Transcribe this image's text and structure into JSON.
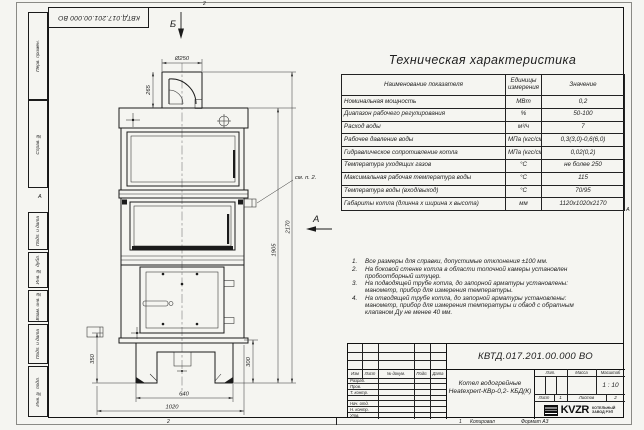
{
  "doc_number": "КВТД.017.201.00.000 ВО",
  "spec_table": {
    "title": "Техническая характеристика",
    "columns": [
      "Наименование показателя",
      "Единицы измерения",
      "Значение"
    ],
    "rows": [
      [
        "Номинальная мощность",
        "МВт",
        "0,2"
      ],
      [
        "Диапазон рабочего регулирования",
        "%",
        "50-100"
      ],
      [
        "Расход воды",
        "м³/ч",
        "7"
      ],
      [
        "Рабочее давление воды",
        "МПа (кгс/см²)",
        "0,3(3,0)-0,6(6,0)"
      ],
      [
        "Гидравлическое сопротивление котла",
        "МПа (кгс/см²)",
        "0,02(0,2)"
      ],
      [
        "Температура уходящих газов",
        "°С",
        "не более 250"
      ],
      [
        "Максимальная рабочая температура воды",
        "°С",
        "115"
      ],
      [
        "Температура воды (вход/выход)",
        "°С",
        "70/95"
      ],
      [
        "Габариты котла (длинна х ширина х высота)",
        "мм",
        "1120х1020х2170"
      ]
    ]
  },
  "notes": [
    {
      "n": "1.",
      "text": "Все размеры для справки, допустимые отклонения ±100 мм."
    },
    {
      "n": "2.",
      "text": "На боковой стенке котла в области топочной камеры установлен пробоотборный штуцер."
    },
    {
      "n": "3.",
      "text": "На подводящей трубе котла, до запорной арматуры установлены: манометр, прибор для измерения температуры."
    },
    {
      "n": "4.",
      "text": "На отводящей трубе котла, до запорной арматуры установлены: манометр, прибор для измерения температуры и обвод с обратным клапаном Ду не менее 40 мм."
    }
  ],
  "dimensions": {
    "chimney_diameter": "Ø250",
    "chimney_height": "265",
    "total_height": "2170",
    "body_height": "1905",
    "nozzle_height": "350",
    "base_height": "300",
    "base_width": "640",
    "overall_width": "1020"
  },
  "view_labels": {
    "view_b": "Б",
    "view_a": "А",
    "detail_ref": "см. п. 2."
  },
  "side_columns": [
    "Перв. примен.",
    "Справ. №",
    "Подп. и дата",
    "Инв. № дубл.",
    "Взам. инв. №",
    "Подп. и дата",
    "Инв. № подл."
  ],
  "title_block": {
    "header_cols": [
      "Изм",
      "Лист",
      "№ докум.",
      "Подп.",
      "Дата"
    ],
    "signature_rows": [
      "Разраб.",
      "Пров.",
      "Т. контр.",
      "",
      "Нач. отд.",
      "Н. контр.",
      "Утв."
    ],
    "product_name_line1": "Котел водогрейные",
    "product_name_line2": "Heatexpert-КВр-0,2- КБД(К)",
    "lit_label": "Лит.",
    "mass_label": "Масса",
    "scale_label": "Масштаб",
    "scale_value": "1 : 10",
    "sheet_label": "Лист",
    "sheet_value": "1",
    "sheets_label": "Листов",
    "sheets_value": "2",
    "logo_text": "KVZR",
    "logo_caption_line1": "КОТЕЛЬНЫЙ",
    "logo_caption_line2": "ЗАВОД РЭП"
  },
  "sheet_margins": {
    "zone_top": "2",
    "zone_bottom": "2",
    "zone_bottom_right": "1",
    "zone_side_left": "А",
    "zone_side_right": "А",
    "copied_label": "Копировал",
    "format_label": "Формат А3"
  }
}
